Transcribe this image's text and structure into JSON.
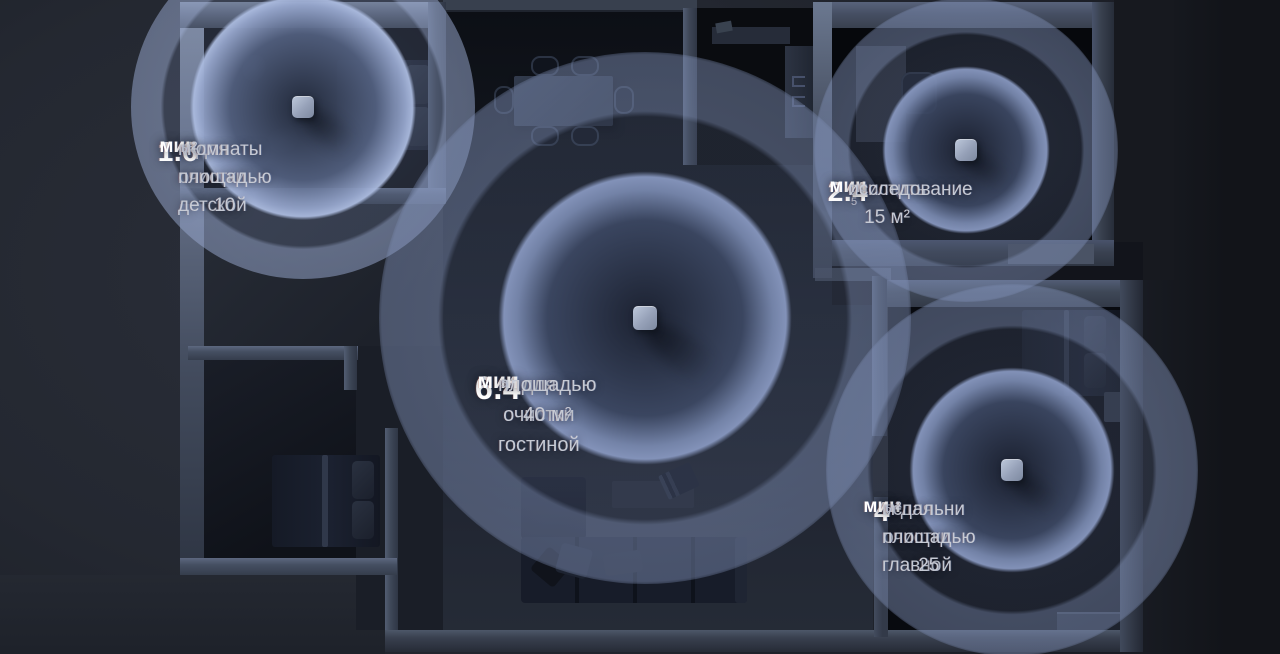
{
  "labels": [
    {
      "id": "childrens-room",
      "value": "1.6",
      "unit": "мин",
      "lines": [
        "для очистки детской",
        "комнаты площадью 10",
        "м²"
      ],
      "footnote": "5"
    },
    {
      "id": "living-room",
      "value": "6.4",
      "unit": "мин",
      "lines": [
        "для очистки гостиной",
        "площадью 40 м²"
      ],
      "footnote": "5"
    },
    {
      "id": "study-room",
      "value": "2.4",
      "unit": "мин",
      "lines": [
        "очистить 15 м²",
        "исследование"
      ],
      "footnote": "5"
    },
    {
      "id": "master-bedroom",
      "value": "4",
      "unit": "мин",
      "lines": [
        "для очистки главной",
        "спальни площадью 25",
        "м²"
      ],
      "footnote": "5"
    }
  ],
  "colors": {
    "text-primary": "#ffffff",
    "text-secondary": "#c6cad4",
    "text-footnote": "#b6bbc7",
    "ring-bright": "#93a4c9",
    "wall": "#3e4757",
    "wall-bright": "#8e9ab0",
    "floor-dark": "#0b0d12",
    "scene-bg": "#23272f",
    "device": "#aab5ca"
  }
}
